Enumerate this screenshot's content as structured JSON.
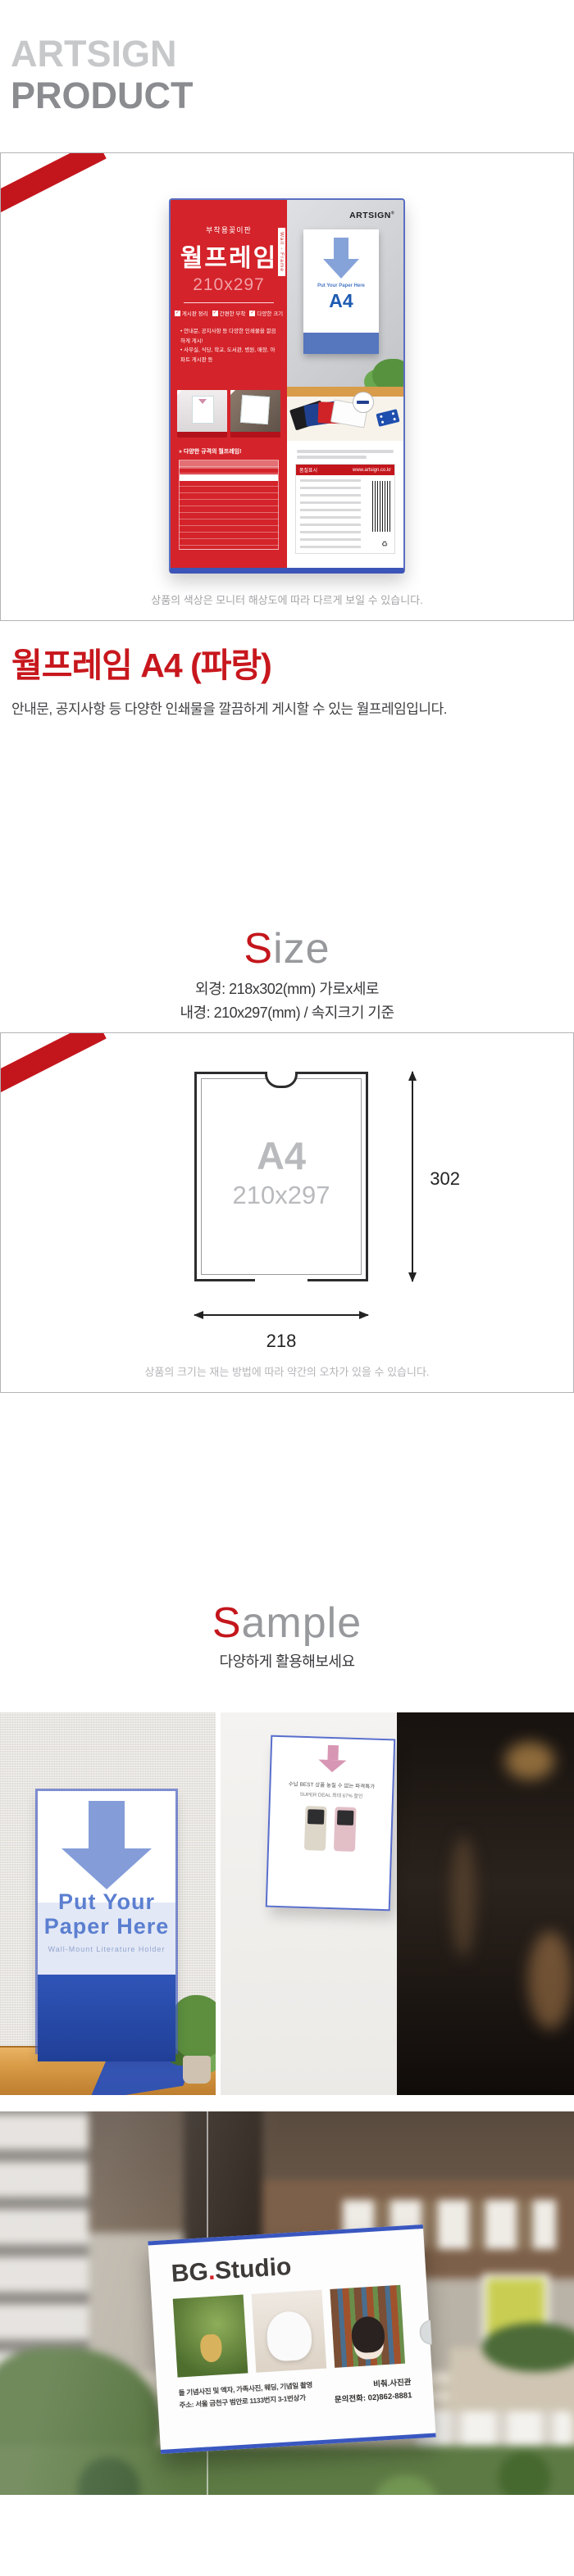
{
  "header": {
    "brand": "ARTSIGN",
    "label": "PRODUCT"
  },
  "product_box": {
    "caption": "상품의 색상은 모니터 해상도에 따라 다르게 보일 수 있습니다.",
    "package": {
      "tagline": "부착용꽂이판",
      "name": "월프레임",
      "size": "210x297",
      "side_label": "Wall - Frame",
      "brand": "ARTSIGN",
      "brand_mark": "®",
      "check_glyph": "✓",
      "features": [
        {
          "label": "게시판 정리"
        },
        {
          "label": "간편한 부착"
        },
        {
          "label": "다양한 크기"
        }
      ],
      "bullet1": "• 안내문, 공지사항 등 다양한 인쇄물을 깔끔하게 게시!",
      "bullet2": "• 사무실, 식당, 학교, 도서관, 병원, 매장, 아파트 게시판 등",
      "insert_text": "Put Your Paper Here",
      "insert_size": "A4",
      "table_title": "» 다양한 규격의 월프레임!",
      "label_title": "품질표시",
      "label_url": "www.artsign.co.kr",
      "recycle_glyph": "♻"
    }
  },
  "intro": {
    "title": "월프레임 A4 (파랑)",
    "description": "안내문, 공지사항 등 다양한 인쇄물을 깔끔하게 게시할 수 있는 월프레임입니다."
  },
  "size_section": {
    "title_accent": "S",
    "title_rest": "ize",
    "line1": "외경: 218x302(mm) 가로x세로",
    "line2": "내경: 210x297(mm) / 속지크기 기준",
    "diagram": {
      "label": "A4",
      "sublabel": "210x297",
      "height": "302",
      "width": "218"
    },
    "caption": "상품의 크기는 재는 방법에 따라 약간의 오차가 있을 수 있습니다."
  },
  "sample_section": {
    "title_accent": "S",
    "title_rest": "ample",
    "subtitle": "다양하게 활용해보세요",
    "photo1": {
      "line1": "Put Your",
      "line2": "Paper Here",
      "subtitle": "Wall-Mount Literature Holder"
    },
    "photo2": {
      "line1": "수납 BEST 상품 놓칠 수 없는 파격특가",
      "line2": "SUPER DEAL 최대 67% 할인"
    },
    "photo3": {
      "title_bg": "BG",
      "title_dot": ".",
      "title_rest": "Studio",
      "info1": "돌 기념사진 및 액자, 가족사진, 웨딩, 기념일 촬영",
      "info2": "주소: 서울 금천구 범안로 1133번지 3-1번상가",
      "shop": "비춰.사진관",
      "phone": "문의전화: 02)862-8881"
    }
  }
}
